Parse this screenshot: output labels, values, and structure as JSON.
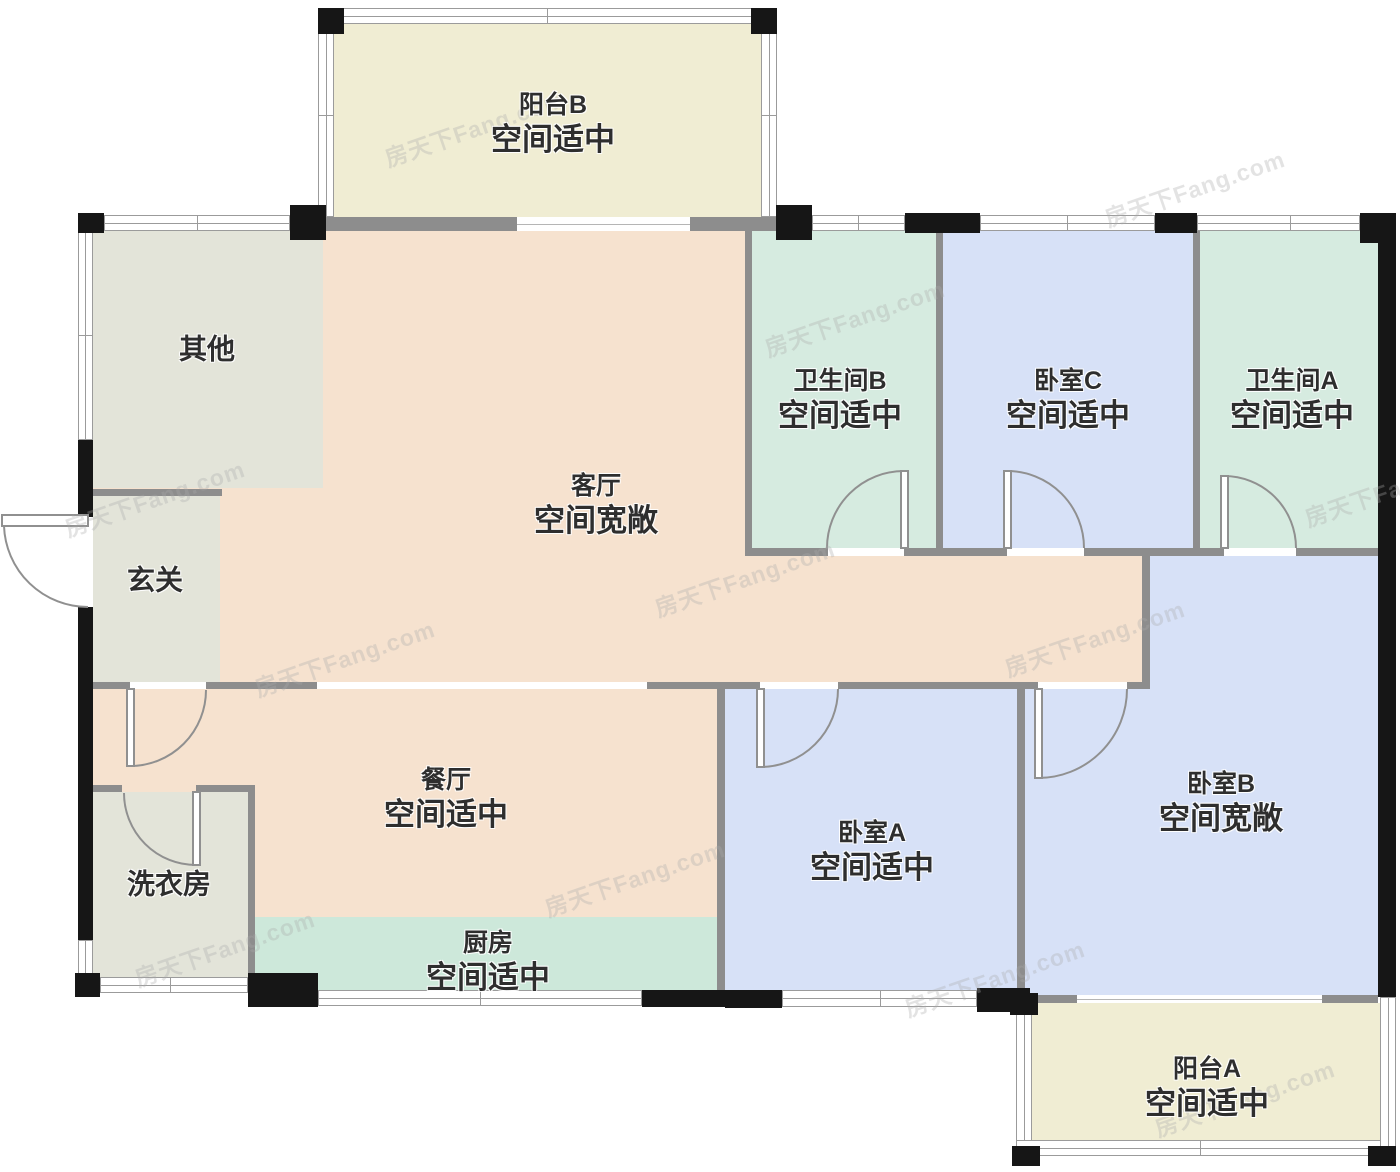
{
  "watermark": "房天下Fang.com",
  "palette": {
    "living": "#f6e2cf",
    "balcony": "#f0edd3",
    "service": "#e3e4d9",
    "bath": "#d6ebe0",
    "bedroom": "#d7e1f7",
    "kitchen": "#cde8da",
    "wall": "#8d8d8d",
    "pillar": "#161616"
  },
  "rooms": [
    {
      "id": "balcony-b",
      "name": "阳台B",
      "desc": "空间适中"
    },
    {
      "id": "other",
      "name": "其他",
      "desc": ""
    },
    {
      "id": "entry",
      "name": "玄关",
      "desc": ""
    },
    {
      "id": "living",
      "name": "客厅",
      "desc": "空间宽敞"
    },
    {
      "id": "bath-b",
      "name": "卫生间B",
      "desc": "空间适中"
    },
    {
      "id": "bedroom-c",
      "name": "卧室C",
      "desc": "空间适中"
    },
    {
      "id": "bath-a",
      "name": "卫生间A",
      "desc": "空间适中"
    },
    {
      "id": "dining",
      "name": "餐厅",
      "desc": "空间适中"
    },
    {
      "id": "laundry",
      "name": "洗衣房",
      "desc": ""
    },
    {
      "id": "kitchen",
      "name": "厨房",
      "desc": "空间适中"
    },
    {
      "id": "bedroom-a",
      "name": "卧室A",
      "desc": "空间适中"
    },
    {
      "id": "bedroom-b",
      "name": "卧室B",
      "desc": "空间宽敞"
    },
    {
      "id": "balcony-a",
      "name": "阳台A",
      "desc": "空间适中"
    }
  ]
}
